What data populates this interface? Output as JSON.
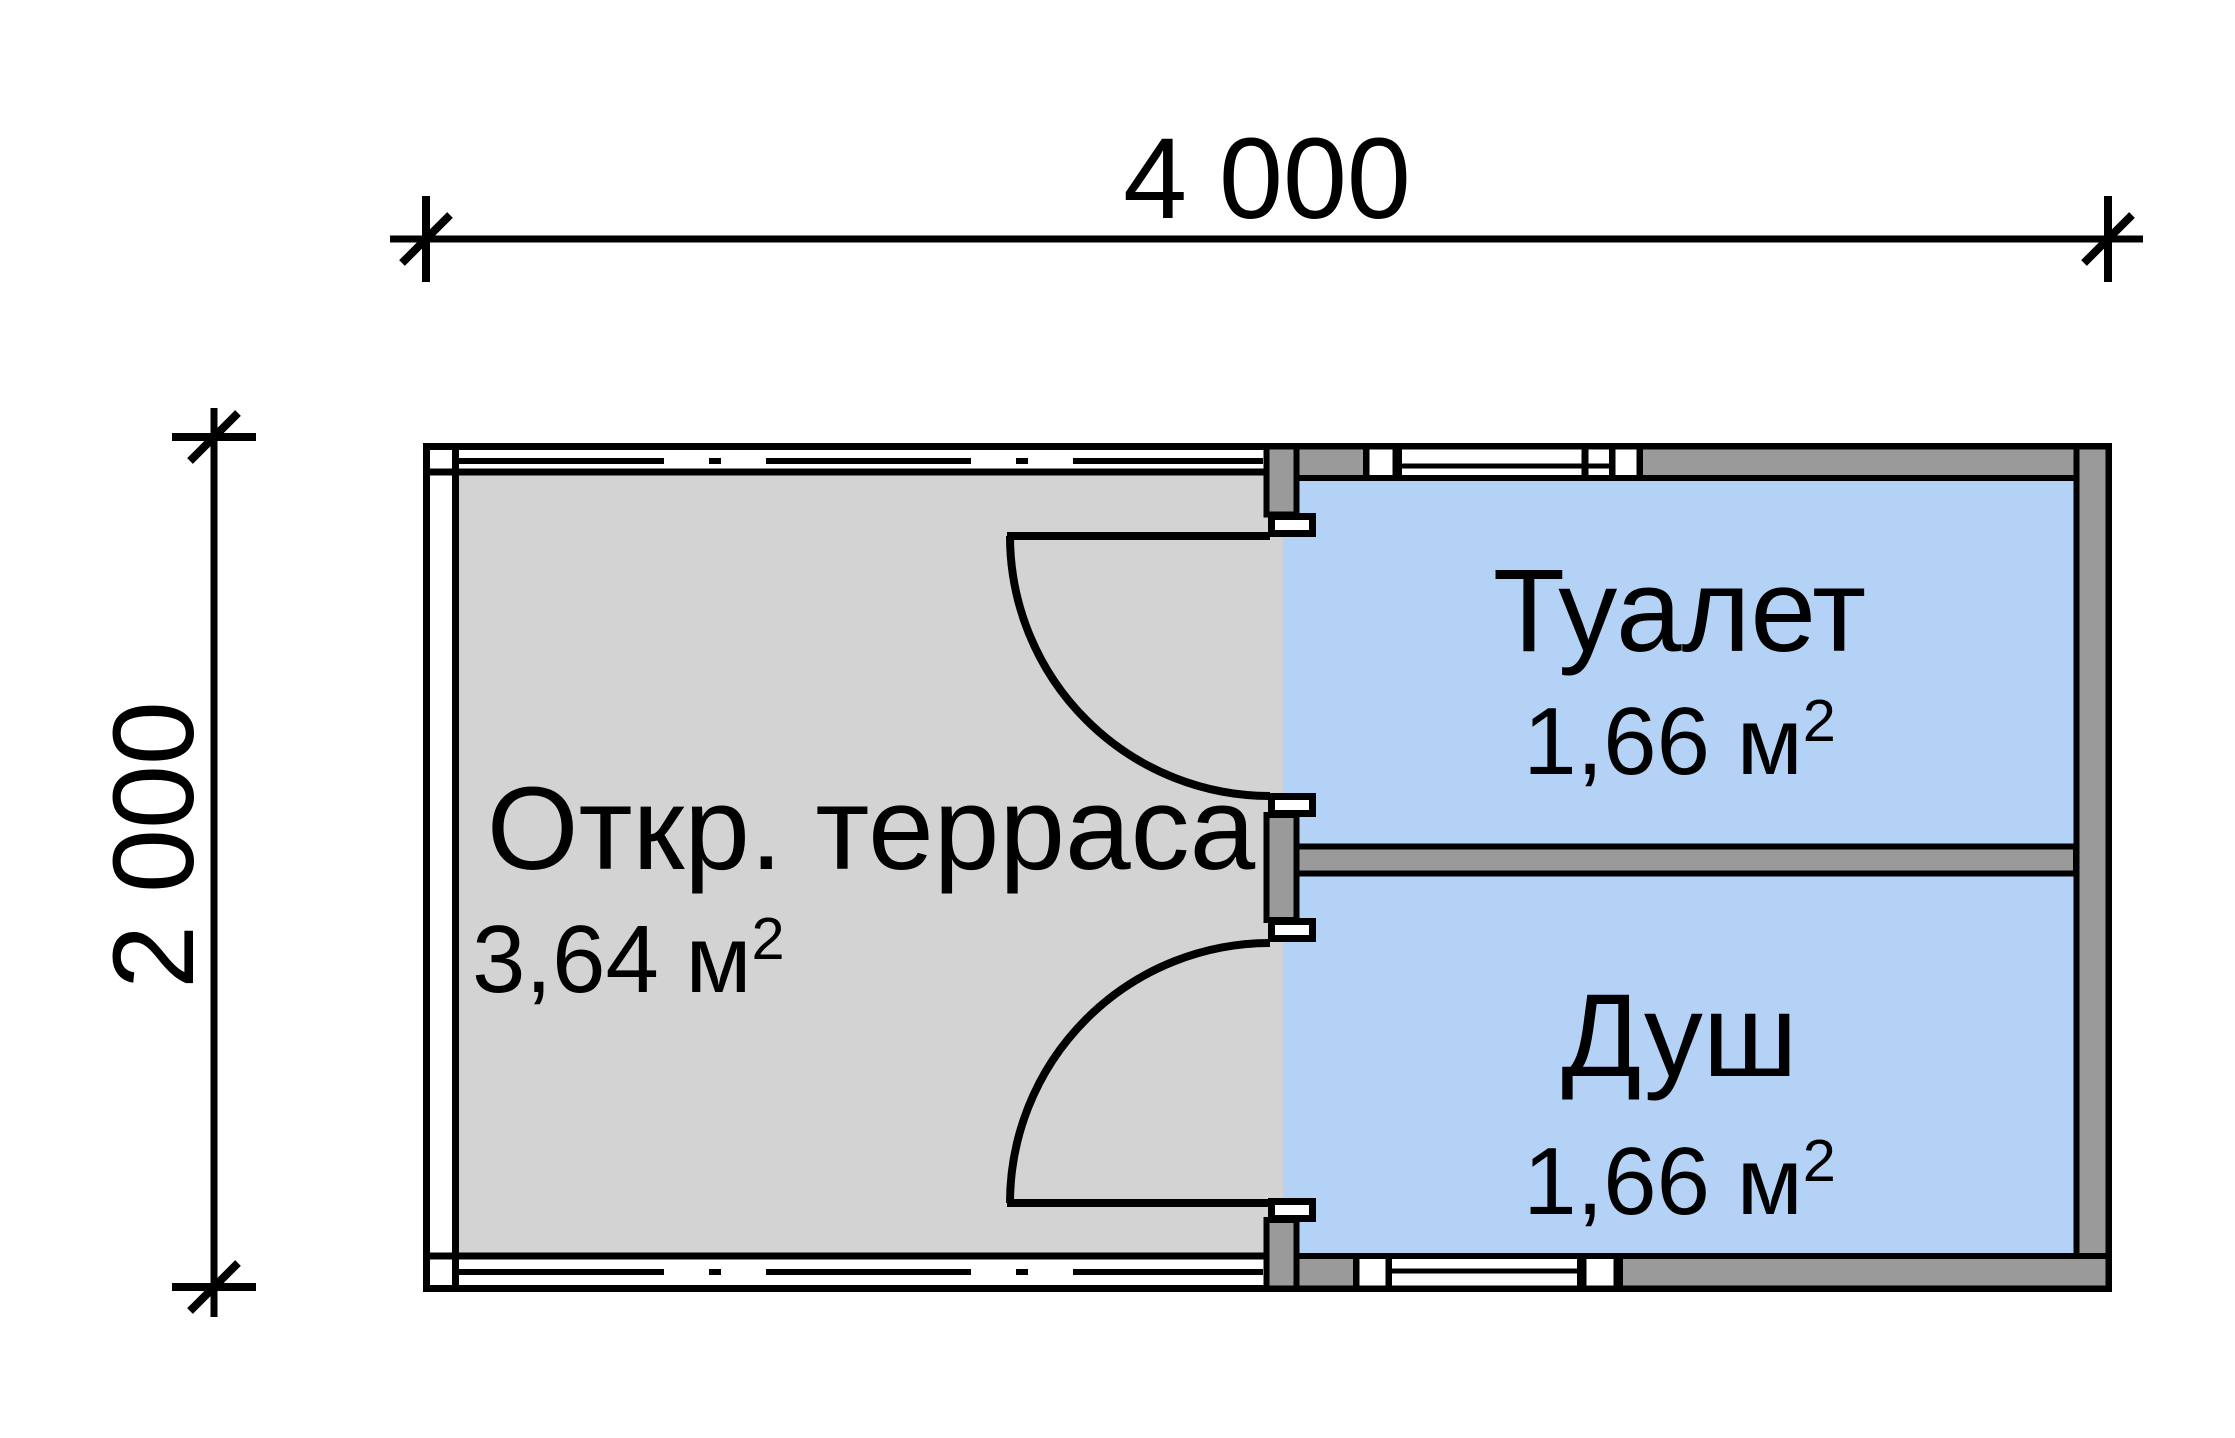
{
  "dimensions": {
    "width_label": "4 000",
    "height_label": "2 000"
  },
  "rooms": {
    "terrace": {
      "name": "Откр. терраса",
      "area": "3,64 м",
      "area_sup": "2"
    },
    "toilet": {
      "name": "Туалет",
      "area": "1,66 м",
      "area_sup": "2"
    },
    "shower": {
      "name": "Душ",
      "area": "1,66 м",
      "area_sup": "2"
    }
  },
  "colors": {
    "background": "#ffffff",
    "terrace_fill": "#d3d3d3",
    "room_fill": "#b4d2f6",
    "wall_fill": "#9a9a9a",
    "jamb_fill": "#ffffff",
    "line": "#000000"
  }
}
